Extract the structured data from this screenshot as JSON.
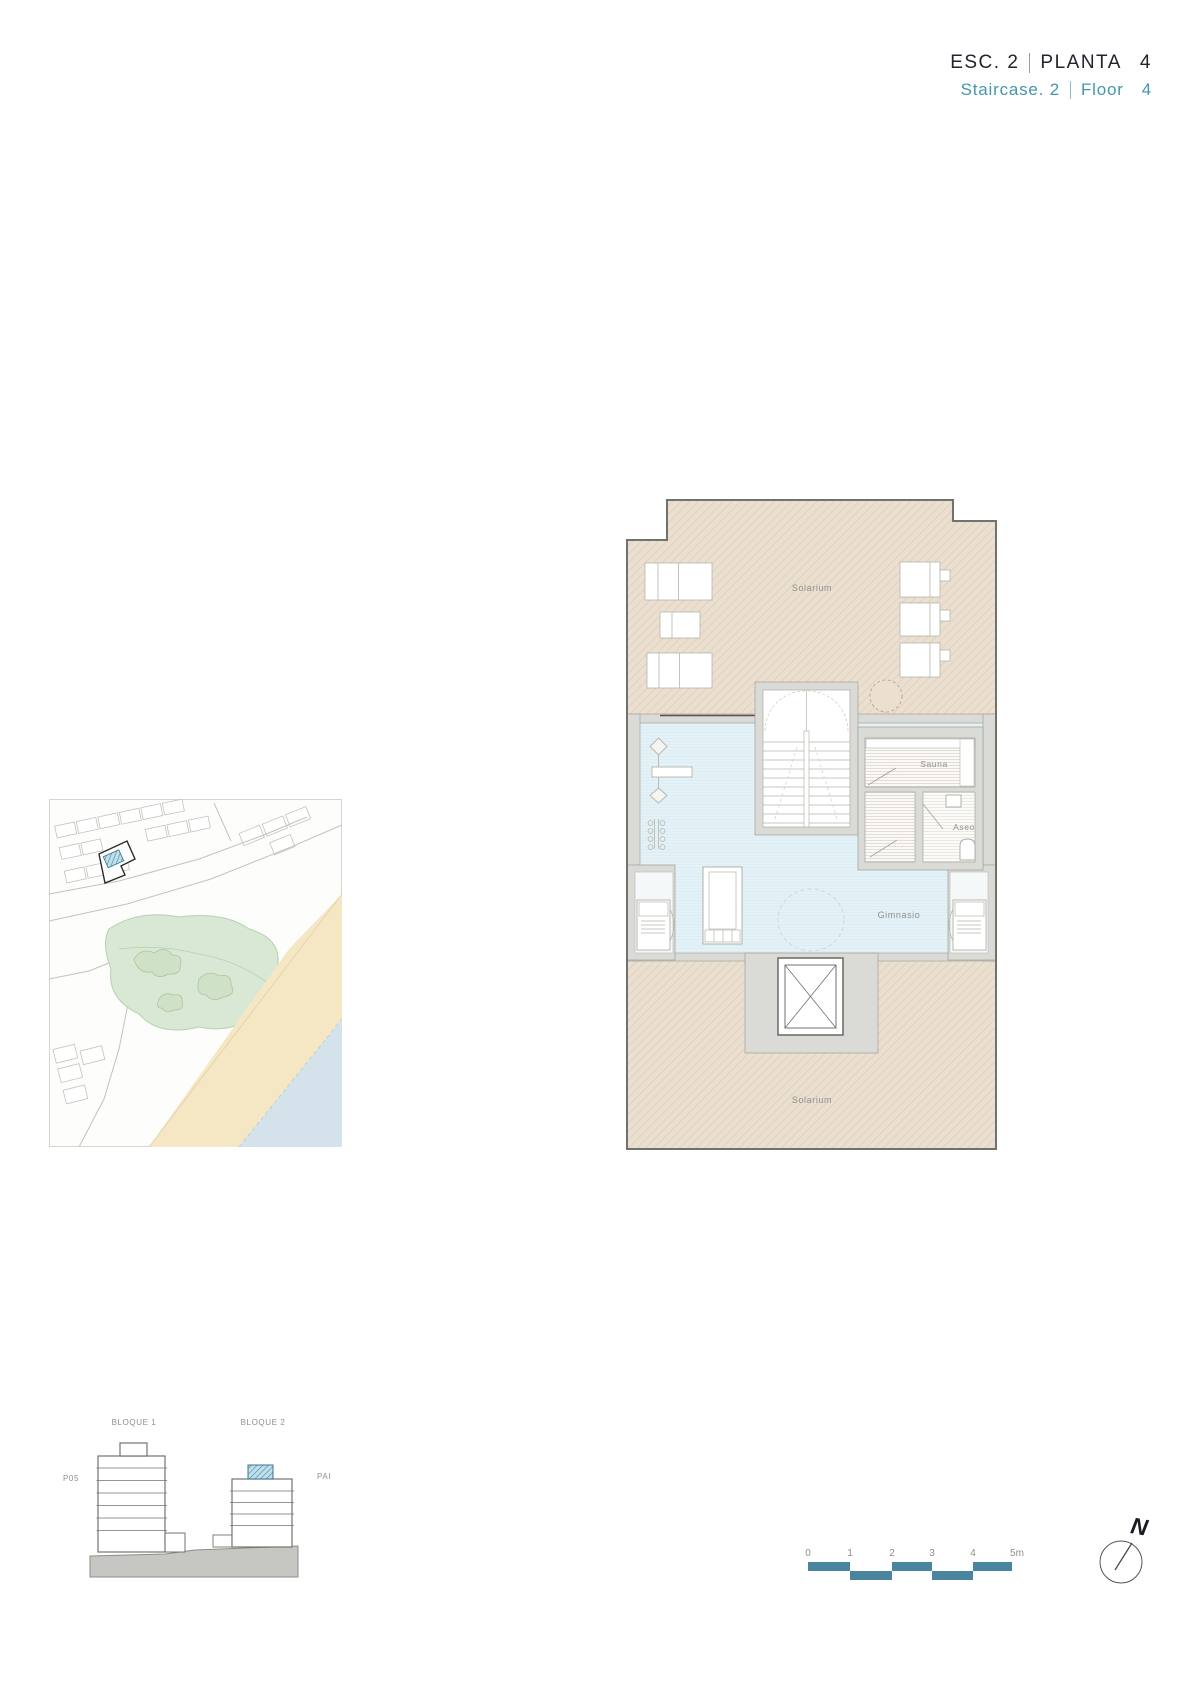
{
  "header": {
    "esc": "ESC. 2",
    "planta": "PLANTA",
    "planta_num": "4",
    "staircase": "Staircase. 2",
    "floor": "Floor",
    "floor_num": "4"
  },
  "plan": {
    "solarium_top": "Solarium",
    "sauna": "Sauna",
    "aseo": "Aseo",
    "gym": "Gimnasio",
    "solarium_bottom": "Solarium"
  },
  "elevation": {
    "block1": "BLOQUE 1",
    "block2": "BLOQUE 2",
    "left_level": "P05",
    "right_level": "PAI"
  },
  "scalebar": {
    "labels": [
      "0",
      "1",
      "2",
      "3",
      "4",
      "5m"
    ]
  },
  "compass": {
    "north": "N"
  },
  "colors": {
    "accent_teal_text": "#4496ae",
    "scalebar_teal": "#4a85a0",
    "title_dark": "#23232d",
    "solarium_tan": "#ebdfd0",
    "gym_blue": "#e4f2f7",
    "wall_gray": "#dadad6",
    "outline_dark": "#72726c",
    "label_gray": "#90908a",
    "park_green": "#d9e8d4",
    "sand": "#f6e7c4",
    "water": "#d4e3eb"
  }
}
